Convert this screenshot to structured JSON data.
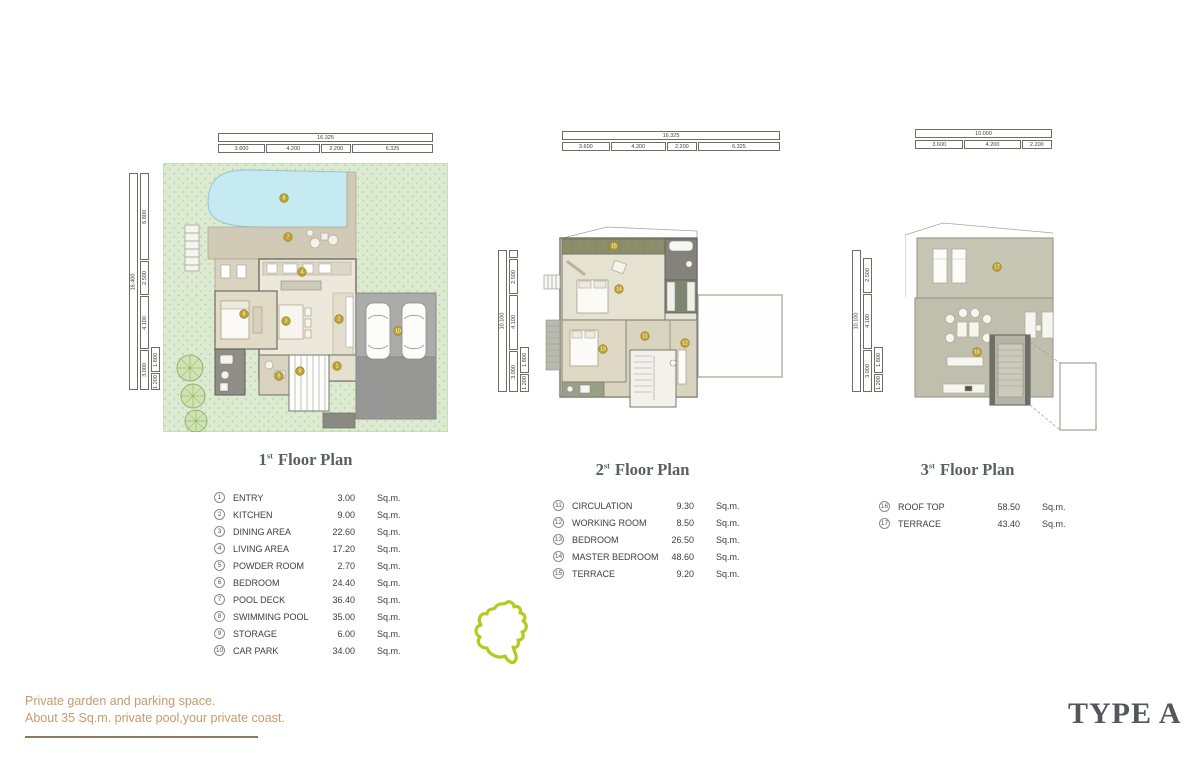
{
  "page": {
    "tagline": [
      "Private garden and parking space.",
      "About 35 Sq.m. private pool,your private coast."
    ],
    "type_label": "TYPE A"
  },
  "labels": {
    "sqm": "Sq.m."
  },
  "colors": {
    "accent_text": "#c59b6d",
    "title_gray": "#5b5e63",
    "marker_gold": "#c0a433",
    "site_outline_green": "#b4ca20",
    "garden_green": "#dcead1",
    "pool_blue": "#c5eaf2",
    "deck_tan": "#d0cab6",
    "carpark_gray": "#a8a8a6",
    "terrace_olive": "#8b8e6a"
  },
  "plans": [
    {
      "title": {
        "num": "1",
        "sup": "st",
        "rest": "Floor Plan"
      },
      "dims": {
        "top_total": "16.325",
        "top_segments": [
          "3.600",
          "4.200",
          "2.200",
          "6.325"
        ],
        "left_total": "16.400",
        "left_segments": [
          "6.800",
          "2.500",
          "4.100",
          "3.000"
        ],
        "left_sub": [
          "1.800",
          "1.200"
        ]
      },
      "legend": [
        {
          "num": "1",
          "name": "ENTRY",
          "value": "3.00"
        },
        {
          "num": "2",
          "name": "KITCHEN",
          "value": "9.00"
        },
        {
          "num": "3",
          "name": "DINING AREA",
          "value": "22.60"
        },
        {
          "num": "4",
          "name": "LIVING AREA",
          "value": "17.20"
        },
        {
          "num": "5",
          "name": "POWDER ROOM",
          "value": "2.70"
        },
        {
          "num": "6",
          "name": "BEDROOM",
          "value": "24.40"
        },
        {
          "num": "7",
          "name": "POOL DECK",
          "value": "36.40"
        },
        {
          "num": "8",
          "name": "SWIMMING POOL",
          "value": "35.00"
        },
        {
          "num": "9",
          "name": "STORAGE",
          "value": "6.00"
        },
        {
          "num": "10",
          "name": "CAR PARK",
          "value": "34.00"
        }
      ]
    },
    {
      "title": {
        "num": "2",
        "sup": "st",
        "rest": "Floor Plan"
      },
      "dims": {
        "top_total": "16.325",
        "top_segments": [
          "3.600",
          "4.200",
          "2.200",
          "6.325"
        ],
        "left_total": "10.100",
        "left_segments": [
          "2.500",
          "4.100",
          "3.000"
        ],
        "left_sub": [
          "1.800",
          "1.200"
        ]
      },
      "legend": [
        {
          "num": "11",
          "name": "CIRCULATION",
          "value": "9.30"
        },
        {
          "num": "12",
          "name": "WORKING ROOM",
          "value": "8.50"
        },
        {
          "num": "13",
          "name": "BEDROOM",
          "value": "26.50"
        },
        {
          "num": "14",
          "name": "MASTER BEDROOM",
          "value": "48.60"
        },
        {
          "num": "15",
          "name": "TERRACE",
          "value": "9.20"
        }
      ]
    },
    {
      "title": {
        "num": "3",
        "sup": "st",
        "rest": "Floor Plan"
      },
      "dims": {
        "top_total": "10.000",
        "top_segments": [
          "3.600",
          "4.200",
          "2.200"
        ],
        "left_total": "10.100",
        "left_segments": [
          "2.500",
          "4.100",
          "3.000"
        ],
        "left_sub": [
          "1.800",
          "1.200"
        ]
      },
      "legend": [
        {
          "num": "16",
          "name": "ROOF TOP",
          "value": "58.50"
        },
        {
          "num": "17",
          "name": "TERRACE",
          "value": "43.40"
        }
      ]
    }
  ]
}
